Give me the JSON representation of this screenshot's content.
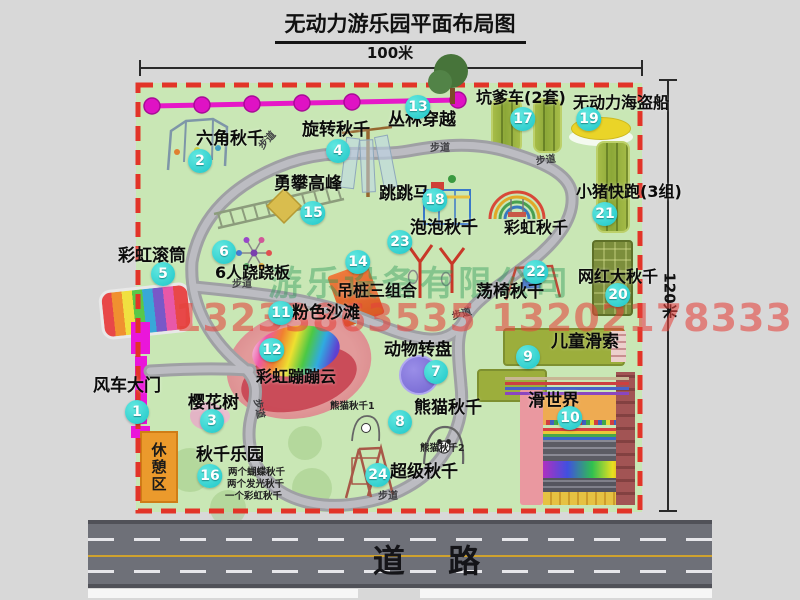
{
  "title": "无动力游乐园平面布局图",
  "dim_width": "100米",
  "dim_height": "120米",
  "road_label": "道 路",
  "rest_area_label": "休憩区",
  "path_label": "步道",
  "watermark": {
    "company": "游乐设备有限公司",
    "phone": "13233863535 13202178333"
  },
  "extra_labels": {
    "rainbow_swing": "彩虹秋千",
    "panda_swing_1": "熊猫秋千1",
    "panda_swing_2": "熊猫秋千2",
    "swing_park_note_1": "两个蝴蝶秋千",
    "swing_park_note_2": "两个发光秋千",
    "swing_park_note_3": "一个彩虹秋千"
  },
  "facilities": [
    {
      "num": "1",
      "name": "风车大门"
    },
    {
      "num": "2",
      "name": "六角秋千"
    },
    {
      "num": "3",
      "name": "樱花树"
    },
    {
      "num": "4",
      "name": "旋转秋千"
    },
    {
      "num": "5",
      "name": "彩虹滚筒"
    },
    {
      "num": "6",
      "name": "6人跷跷板"
    },
    {
      "num": "7",
      "name": "动物转盘"
    },
    {
      "num": "8",
      "name": "熊猫秋千"
    },
    {
      "num": "9",
      "name": "儿童滑索"
    },
    {
      "num": "10",
      "name": "滑世界"
    },
    {
      "num": "11",
      "name": "粉色沙滩"
    },
    {
      "num": "12",
      "name": "彩虹蹦蹦云"
    },
    {
      "num": "13",
      "name": "丛林穿越"
    },
    {
      "num": "14",
      "name": "吊桩三组合"
    },
    {
      "num": "15",
      "name": "勇攀高峰"
    },
    {
      "num": "16",
      "name": "秋千乐园"
    },
    {
      "num": "17",
      "name": "坑爹车(2套)"
    },
    {
      "num": "18",
      "name": "跳跳马"
    },
    {
      "num": "19",
      "name": "无动力海盗船"
    },
    {
      "num": "20",
      "name": "网红大秋千"
    },
    {
      "num": "21",
      "name": "小猪快跑(3组)"
    },
    {
      "num": "22",
      "name": "荡椅秋千"
    },
    {
      "num": "23",
      "name": "泡泡秋千"
    },
    {
      "num": "24",
      "name": "超级秋千"
    }
  ],
  "colors": {
    "map_bg": "#c9e7b5",
    "border_red": "#e23428",
    "badge_cyan": "#1ec6c8",
    "chain_magenta": "#e618c8",
    "gate_magenta": "#ea16da",
    "road_gray": "#6e7078",
    "rest_area_orange": "#eb9a2c"
  }
}
